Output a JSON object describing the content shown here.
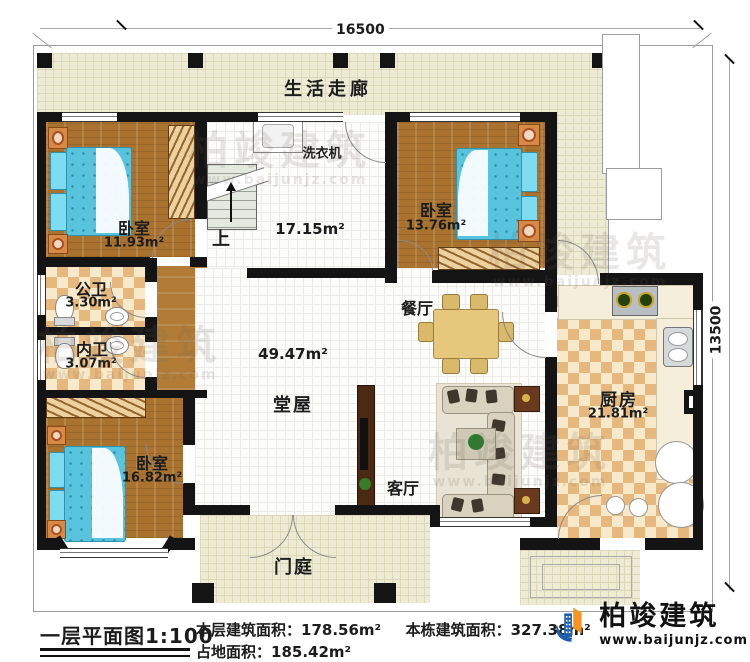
{
  "dimensions": {
    "width_mm": "16500",
    "height_mm": "13500"
  },
  "rooms": {
    "corridor": {
      "name": "生活走廊"
    },
    "laundry": {
      "appliance": "洗衣机",
      "area": "17.15m²"
    },
    "stairs": {
      "direction_label": "上"
    },
    "bedroom_top_left": {
      "name": "卧室",
      "area": "11.93m²"
    },
    "bedroom_top_right": {
      "name": "卧室",
      "area": "13.76m²"
    },
    "public_bath": {
      "name": "公卫",
      "area": "3.30m²"
    },
    "private_bath": {
      "name": "内卫",
      "area": "3.07m²"
    },
    "bedroom_bottom_left": {
      "name": "卧室",
      "area": "16.82m²"
    },
    "hall": {
      "name": "堂屋",
      "area": "49.47m²"
    },
    "dining": {
      "name": "餐厅"
    },
    "living": {
      "name": "客厅"
    },
    "kitchen": {
      "name": "厨房",
      "area": "21.81m²"
    },
    "porch": {
      "name": "门庭"
    }
  },
  "title_block": {
    "plan_title": "一层平面图1:100",
    "floor_area_label": "本层建筑面积：",
    "floor_area_value": "178.56m²",
    "building_area_label": "本栋建筑面积：",
    "building_area_value": "327.38m²",
    "land_area_label": "占地面积：",
    "land_area_value": "185.42m²"
  },
  "logo": {
    "company": "柏竣建筑",
    "website": "www.baijunjz.com"
  },
  "watermark": {
    "company": "柏竣建筑",
    "website": "www.baijunjz.com"
  }
}
